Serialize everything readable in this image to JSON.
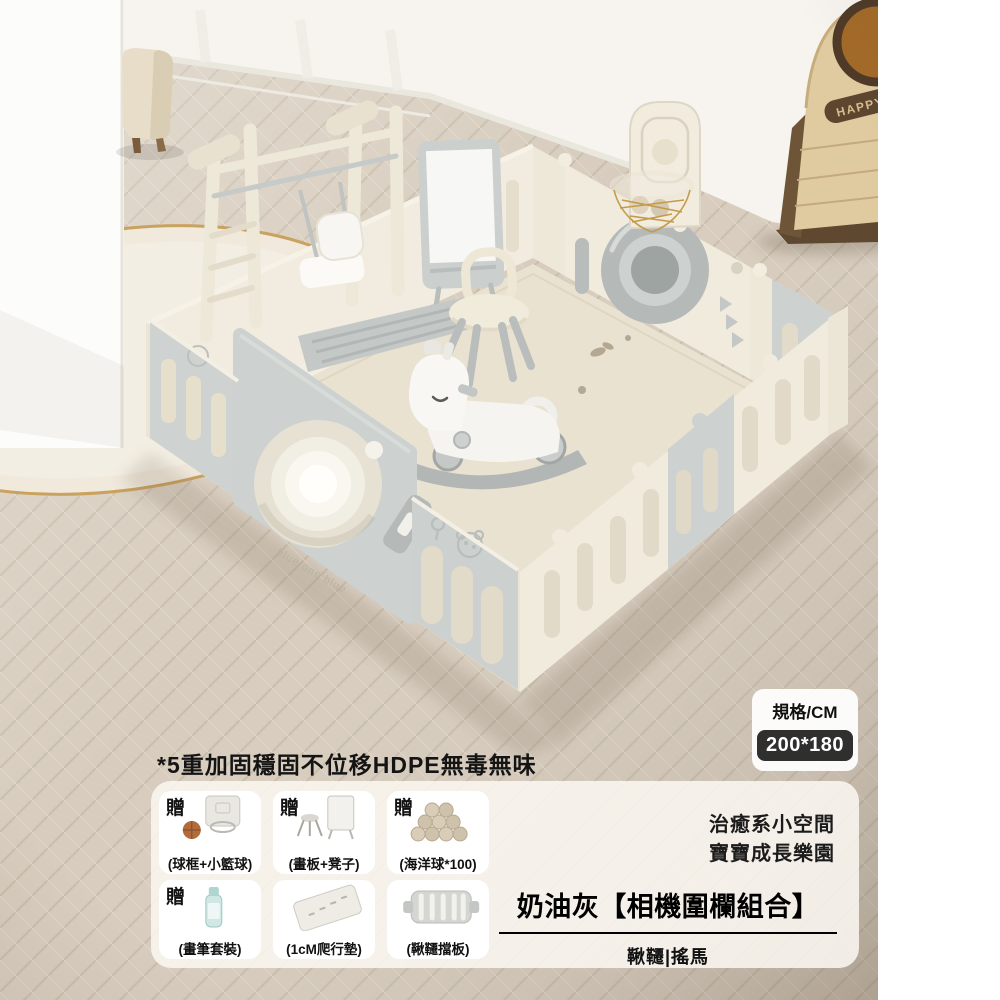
{
  "image": {
    "happy_label": "HAPPY",
    "gate_brand_text": "blue one blue"
  },
  "spec_card": {
    "label": "規格/CM",
    "value": "200*180"
  },
  "headline": "*5重加固穩固不位移HDPE無毒無味",
  "info_panel": {
    "gifts": [
      {
        "badge": "贈",
        "caption": "(球框+小籃球)",
        "icon": "basketball-hoop-icon"
      },
      {
        "badge": "贈",
        "caption": "(畫板+凳子)",
        "icon": "easel-stool-icon"
      },
      {
        "badge": "贈",
        "caption": "(海洋球*100)",
        "icon": "ocean-balls-icon"
      },
      {
        "badge": "贈",
        "caption": "(畫筆套裝)",
        "icon": "paint-set-icon"
      },
      {
        "badge": "",
        "caption": "(1cM爬行墊)",
        "icon": "crawl-mat-icon"
      },
      {
        "badge": "",
        "caption": "(鞦韆擋板)",
        "icon": "swing-baffle-icon"
      }
    ],
    "slogan_line1": "治癒系小空間",
    "slogan_line2": "寶寶成長樂園",
    "title": "奶油灰【相機圍欄組合】",
    "subtitle": "鞦韆|搖馬"
  },
  "colors": {
    "badge_bg": "#2f2f2f",
    "badge_text": "#ffffff",
    "panel_bg": "rgba(251,248,242,0.85)",
    "card_bg": "#ffffff",
    "cream_panel": "#efe9db",
    "grey_panel": "#ccd1cf",
    "mat": "#eae2d1",
    "floor_wood": "#d7ccbd",
    "cabinet_wood": "#e0cba1",
    "cabinet_dark": "#6b5238",
    "gold_trim": "#c9a25f"
  }
}
